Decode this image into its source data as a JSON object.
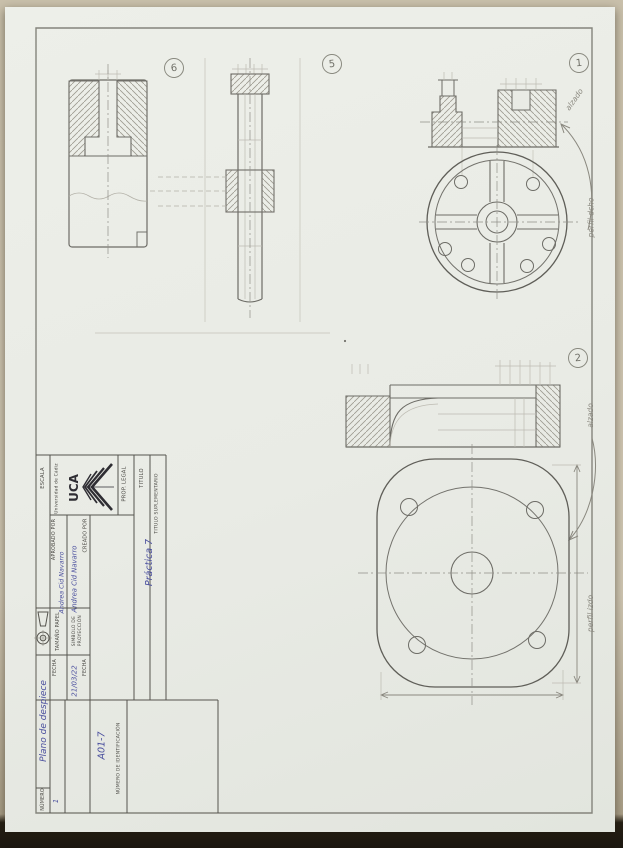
{
  "sheet": {
    "balloons": {
      "part6": "6",
      "part5": "5",
      "part1": "1",
      "part2": "2"
    },
    "annotations": {
      "view1_name": "alzado",
      "view1_side": "perfil dcho",
      "view2_name": "alzado",
      "view2_side": "perfil izdo"
    }
  },
  "title_block": {
    "org": {
      "acronym": "UCA",
      "name": "Universidad de Cádiz"
    },
    "labels": {
      "prop_legal": "PROP. LEGAL",
      "titulo": "TITULO",
      "titulo_suplementario": "TITULO SUPLEMENTARIO",
      "creado_por": "CREADO POR",
      "aprobado_por": "APROBADO POR",
      "fecha": "FECHA",
      "fecha2": "FECHA",
      "escala": "ESCALA",
      "tamano_papel": "TAMAÑO PAPEL",
      "simbolo": "SIMBOLO DE PROYECCIÓN",
      "numero": "NÚMERO",
      "numero_identificacion": "NÚMERO DE IDENTIFICACIÓN"
    },
    "values": {
      "titulo": "Práctica 7",
      "creado_por": "Andrea Cid Navarro",
      "aprobado_por": "Andrea Cid Navarro",
      "fecha": "21/03/22",
      "plano": "Plano de despiece",
      "numero": "1",
      "numero_identificacion": "A01-7"
    }
  },
  "colors": {
    "pen_blue": "#4a4f9e",
    "pencil": "#73726c",
    "paper": "#e9ebe5"
  }
}
